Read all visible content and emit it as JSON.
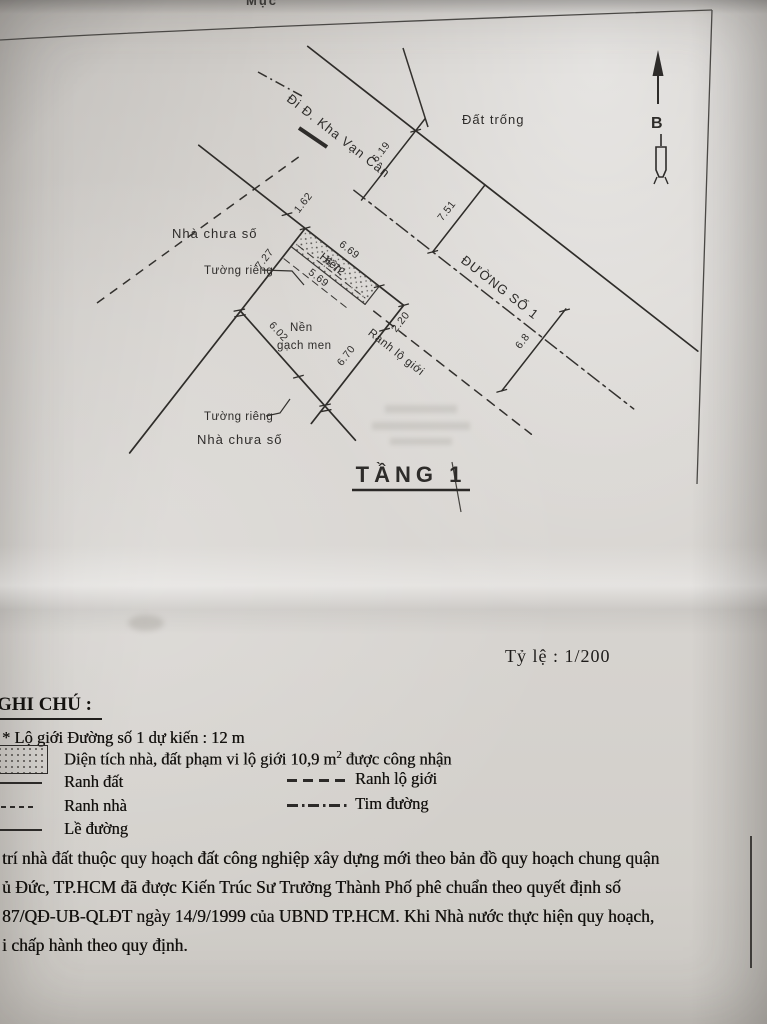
{
  "page": {
    "top_partial_text": "Mục",
    "scale_label": "Tỷ lệ : 1/200"
  },
  "drawing": {
    "floor_title": "TẦNG 1",
    "north_label": "B",
    "labels": {
      "vacant_land": "Đất trống",
      "street1": "ĐƯỜNG SỐ 1",
      "to_kha_van_can": "Đi Đ. Kha Vạn Cân",
      "house_no_number": "Nhà chưa số",
      "private_wall": "Tường riêng",
      "tiled_floor_line1": "Nền",
      "tiled_floor_line2": "gạch men",
      "porch": "Hiên",
      "row_boundary": "Ranh lộ giới"
    },
    "dimensions": {
      "d162": "1.62",
      "d669": "6.69",
      "d220": "2.20",
      "d672": "6.72",
      "d569": "5.69",
      "d727": "7.27",
      "d602": "6.02",
      "d670": "6.70",
      "d619": "6.19",
      "d751": "7.51",
      "d68": "6.8"
    }
  },
  "legend": {
    "title": "GHI CHÚ :",
    "note": "* Lộ giới Đường số 1 dự kiến : 12 m",
    "area_note_prefix": "Diện tích nhà, đất phạm vi lộ giới 10,9 m",
    "area_note_sup": "2",
    "area_note_suffix": " được công nhận",
    "items": {
      "ranh_dat": "Ranh đất",
      "ranh_nha": "Ranh nhà",
      "le_duong": "Lề đường",
      "ranh_lo_gioi": "Ranh lộ giới",
      "tim_duong": "Tim đường"
    }
  },
  "notes": {
    "line1": "trí nhà đất thuộc quy hoạch đất công nghiệp xây dựng mới theo bản đồ quy hoạch chung quận",
    "line2": "ủ Đức, TP.HCM đã được Kiến Trúc Sư Trưởng Thành Phố phê chuẩn theo quyết định số",
    "line3": "87/QĐ-UB-QLĐT ngày 14/9/1999 của UBND TP.HCM. Khi Nhà nước thực hiện quy hoạch,",
    "line4": "i chấp hành theo quy định."
  }
}
